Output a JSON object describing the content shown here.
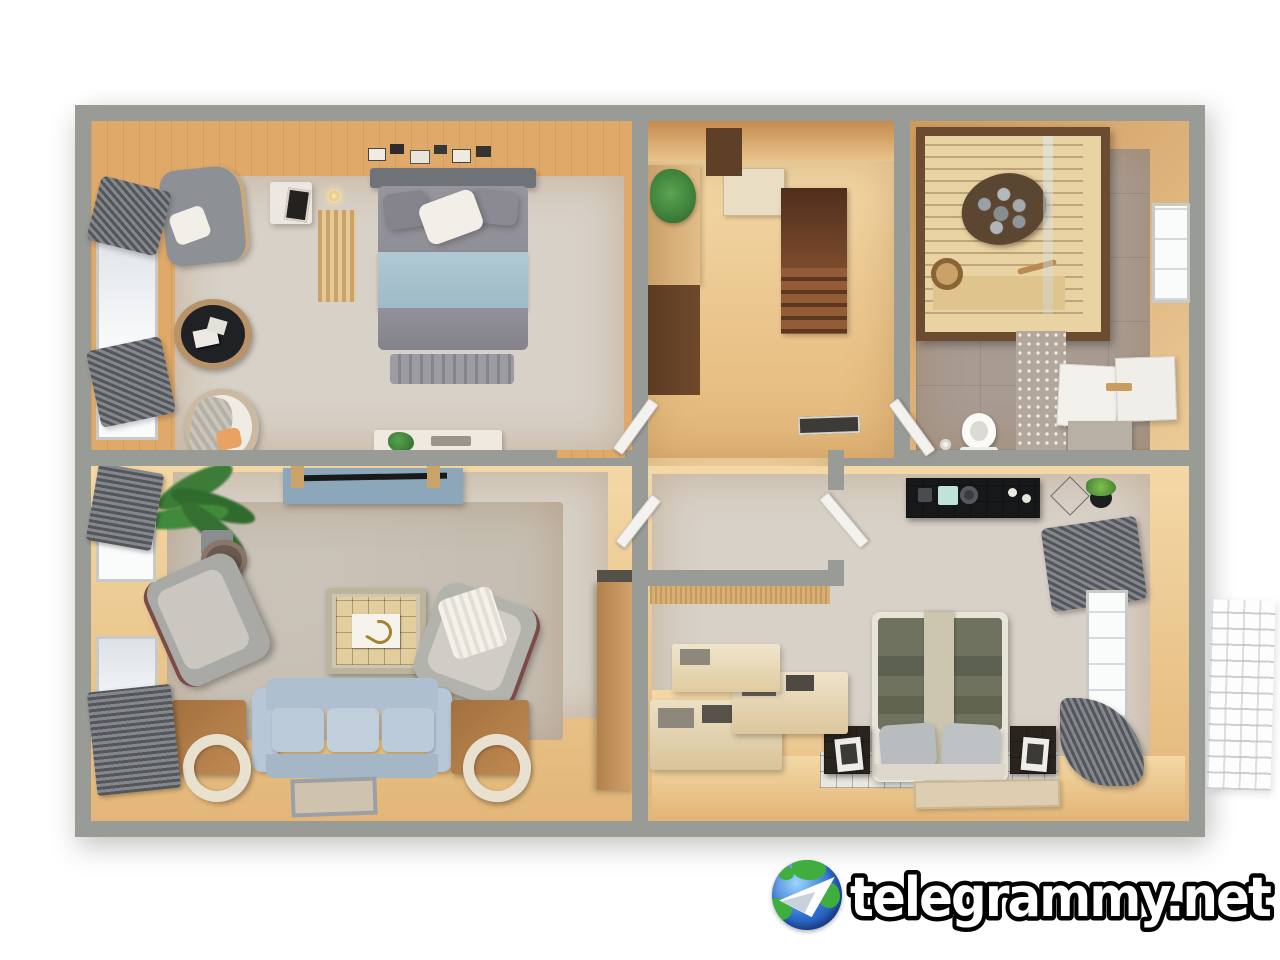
{
  "watermark": {
    "text": "telegrammy.net",
    "logo_icon": "telegram-globe-paper-plane-icon"
  },
  "colors": {
    "wall": "#999b97",
    "wall-dark": "#8b8e8a",
    "wood-dark": "#b97a45",
    "wood-mid": "#d9a468",
    "wood-light": "#f0d2a0",
    "hall-floor": "#e9cf9c",
    "plank-white": "#d8d1c7",
    "carpet": "#c6beb2",
    "tile": "#a89b91",
    "sauna-wood": "#ead3a3",
    "sauna-frame": "#6b4c30",
    "stairs-dark": "#6e4128",
    "stairs-mid": "#8a5635",
    "sofa": "#b7c7d7",
    "tv": "#8ca6ba",
    "duvet": "#8e8d95",
    "blanket": "#a9c3ce",
    "olive": "#6e725e",
    "runner": "#ccc6ae",
    "curtain": "#5f6265",
    "plant": "#3c7c38",
    "cream": "#e9e1cf",
    "blacktile": "#17181a",
    "white": "#f2efe9",
    "logo-blue": "#2f6fd0",
    "logo-green": "#3fae3f"
  }
}
